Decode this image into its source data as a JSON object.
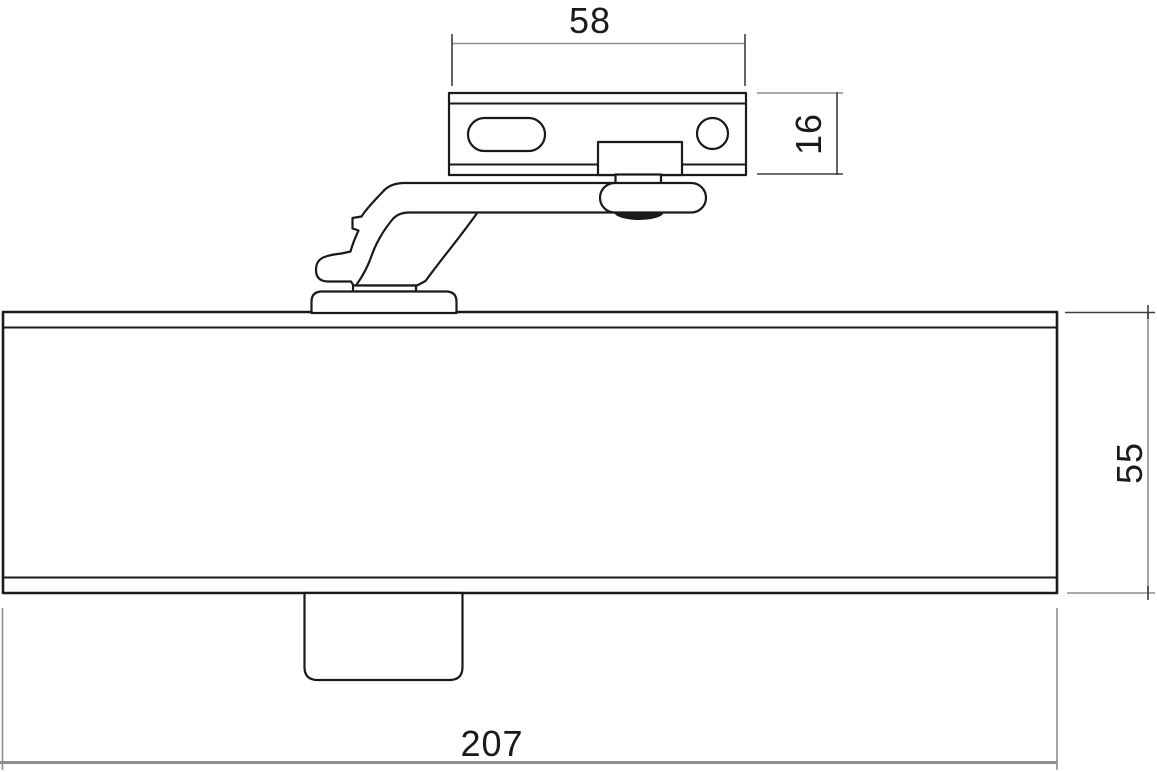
{
  "diagram": {
    "description": "Technical line drawing of an overhead door closer (body, arm and mounting bracket), side elevation with dimensions",
    "dimensions": {
      "bracket_width": "58",
      "bracket_height": "16",
      "body_height": "55",
      "body_length": "207"
    },
    "colors": {
      "outline": "#1a1a1a",
      "dim_line": "#8e8e8e",
      "ext_line": "#3d3d3d",
      "label_text": "#1a1a1a",
      "background": "#ffffff"
    }
  }
}
